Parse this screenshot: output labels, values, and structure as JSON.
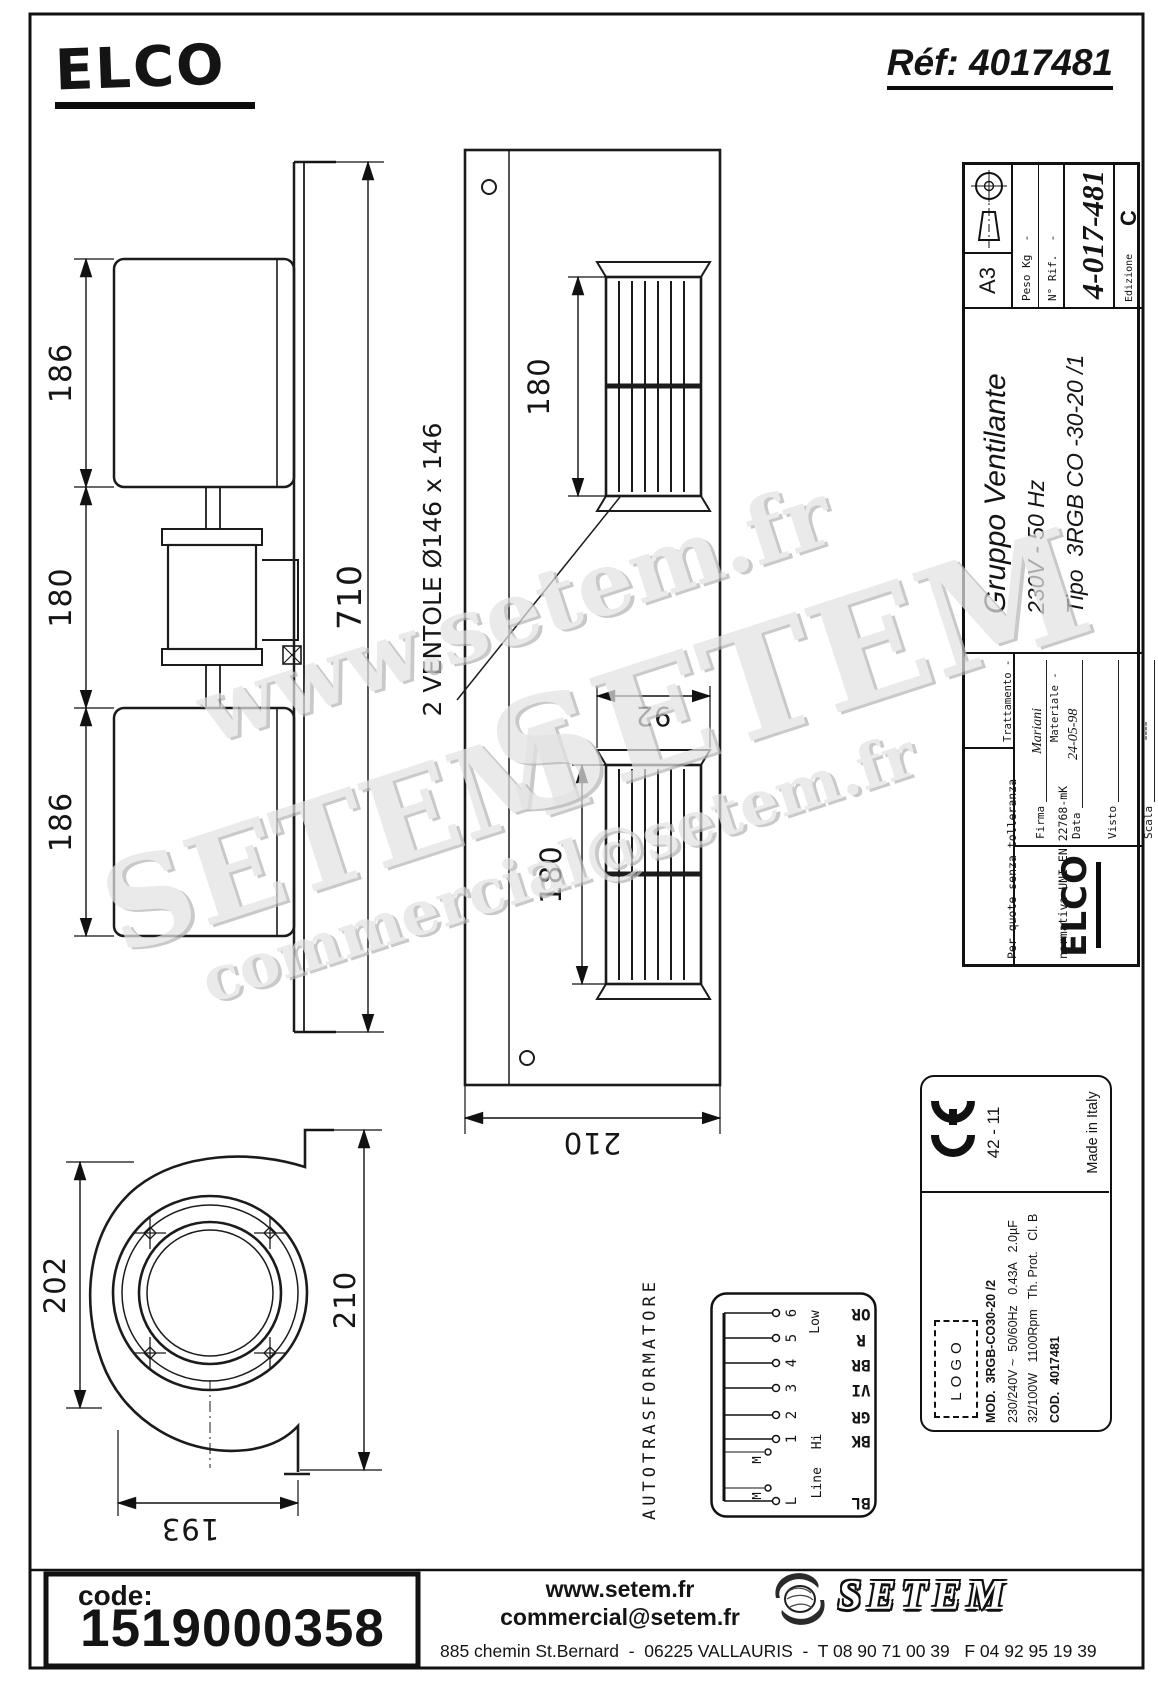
{
  "header": {
    "brand_logo": "ELCO",
    "ref": "Réf: 4017481"
  },
  "dimensions": {
    "front_top": "186",
    "front_mid": "180",
    "front_bottom": "186",
    "front_overall": "710",
    "panel_grille_top": "180",
    "panel_grille_bottom": "180",
    "panel_slot_width": "92",
    "panel_width": "210",
    "fan_label": "2 VENTOLE Ø146 x 146",
    "blower_left": "202",
    "blower_right": "210",
    "blower_bottom": "193"
  },
  "title_block": {
    "tol1": "Per quote senza tolleranza",
    "tol2": "normativa UNI EN 22768-mK",
    "treat_label": "Trattamento -",
    "mat_label": "Materiale -",
    "logo": "ELCO",
    "rows": [
      {
        "label": "Firma",
        "value": "Mariani"
      },
      {
        "label": "Data",
        "value": "24-05-98"
      },
      {
        "label": "Visto",
        "value": ""
      },
      {
        "label": "Scala",
        "value": "----"
      }
    ],
    "title1": "Gruppo Ventilante",
    "title2": "230V - 50 Hz",
    "title3": "Tipo  3RGB CO -30-20 /1",
    "peso": "Peso Kg  -",
    "rif": "N° Rif.  -",
    "number": "4-017-481",
    "format": "A3",
    "edition_label": "Edizione",
    "edition_value": "C"
  },
  "label_plate": {
    "batch": "42 - 11",
    "made_in": "Made in Italy",
    "logo_placeholder": "LOGO",
    "line_mod": "MOD.  3RGB-CO30-20 /2",
    "line_electrical": "230/240V ~  50/60Hz   0.43A   2.0µF",
    "line_power": "32/100W   1100Rpm   Th. Prot.   Cl. B",
    "line_cod": "COD.  4017481"
  },
  "autotransformer": {
    "title": "AUTOTRASFORMATORE",
    "terminals": [
      "L",
      "1",
      "2",
      "3",
      "4",
      "5",
      "6"
    ],
    "motor_label": "M",
    "line_hi": "Line Hi",
    "low": "Low",
    "wire_colors": [
      "OR",
      "R",
      "BR",
      "VI",
      "GR",
      "BK",
      "BL"
    ]
  },
  "watermarks": {
    "line1": "www.setem.fr",
    "line2": "SETEM",
    "line3": "SETEM",
    "line4": "commercial@setem.fr"
  },
  "footer": {
    "code_label": "code:",
    "code_value": "1519000358",
    "website": "www.setem.fr",
    "email": "commercial@setem.fr",
    "address": "885 chemin St.Bernard  -  06225 VALLAURIS  -  T 08 90 71 00 39   F 04 92 95 19 39",
    "brand": "SETEM"
  }
}
